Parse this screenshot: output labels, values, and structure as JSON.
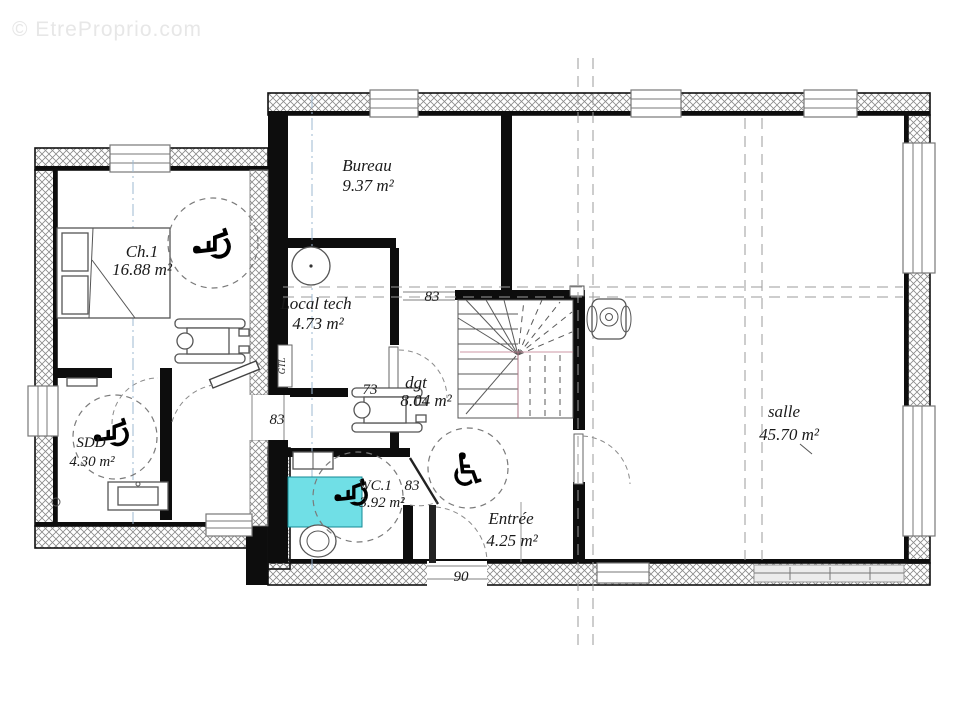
{
  "watermark": {
    "text": "© EtreProprio.com"
  },
  "icons": {
    "wheelchair": "♿"
  },
  "rooms": {
    "ch1": {
      "name": "Ch.1",
      "area": "16.88 m²"
    },
    "bureau": {
      "name": "Bureau",
      "area": "9.37 m²"
    },
    "local_tech": {
      "name": "Local tech",
      "area": "4.73 m²"
    },
    "dgt": {
      "name": "dgt",
      "area": "8.04 m²"
    },
    "sdd": {
      "name": "SDD",
      "area": "4.30 m²"
    },
    "wc1": {
      "name": "WC.1",
      "area": "3.92 m²"
    },
    "entree": {
      "name": "Entrée",
      "area": "4.25 m²"
    },
    "salle": {
      "name": "salle",
      "area": "45.70 m²"
    }
  },
  "dimensions": {
    "bureau_passage": "83",
    "dgt_opening": "73",
    "hall_door": "83",
    "wc_door": "83",
    "entry_door": "90"
  },
  "labels": {
    "gtl": "GTL"
  },
  "colors": {
    "shower": "#70dfe6",
    "wall": "#0d0d0d"
  }
}
